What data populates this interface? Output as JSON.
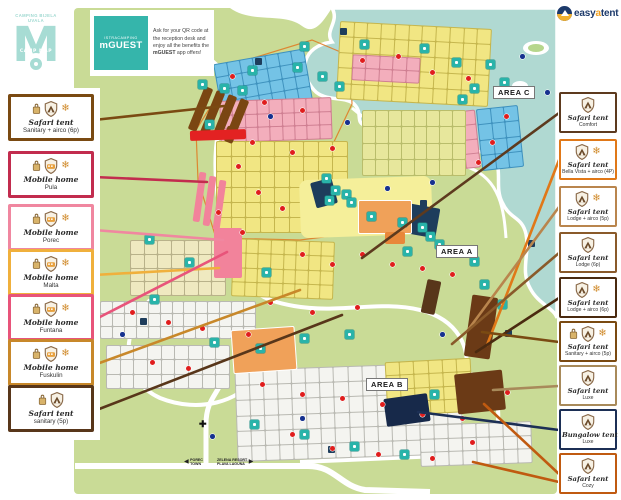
{
  "header": {
    "logo": {
      "line1": "CAMPING BIJELA UVALA",
      "mark": "M",
      "band": "CAMP MAP"
    },
    "mguest": {
      "brand_top": "ISTRACAMPING",
      "brand": "mGUEST",
      "body": "Ask for your QR code at the reception desk and enjoy all the benefits the ",
      "body_bold": "mGUEST",
      "body_end": " app offers!"
    },
    "easyatent": {
      "part1": "easy",
      "part2": "a",
      "part3": "tent"
    }
  },
  "palette": {
    "land": "#c9db96",
    "sea": "#b0d9d2",
    "road": "#ffffff",
    "facility": "#29b3a9",
    "plot_yellow": "#f1e683",
    "plot_pink": "#f3aebc",
    "plot_blue": "#74c3e6",
    "plot_white": "#f4f4f0",
    "red_marker": "#e01d1d",
    "blue_marker": "#16318f"
  },
  "legend_left": [
    {
      "title": "Safari tent",
      "sub": "Sanitary + airco (6p)",
      "color": "#7a4a12",
      "icons": [
        "bag",
        "shield-tent",
        "snow"
      ],
      "top": 94,
      "line_to": [
        224,
        106
      ]
    },
    {
      "title": "Mobile home",
      "sub": "Pula",
      "color": "#c22c4e",
      "icons": [
        "bag",
        "shield-home",
        "snow"
      ],
      "top": 151,
      "line_to": [
        207,
        182
      ]
    },
    {
      "title": "Mobile home",
      "sub": "Porec",
      "color": "#f087a0",
      "icons": [
        "bag",
        "shield-home",
        "snow"
      ],
      "top": 204,
      "line_to": [
        223,
        240
      ]
    },
    {
      "title": "Mobile home",
      "sub": "Malta",
      "color": "#f0b03c",
      "icons": [
        "bag",
        "shield-home",
        "snow"
      ],
      "top": 249,
      "line_to": [
        219,
        268
      ]
    },
    {
      "title": "Mobile home",
      "sub": "Funtana",
      "color": "#e8547a",
      "icons": [
        "bag",
        "shield-home",
        "snow"
      ],
      "top": 294,
      "line_to": [
        227,
        252
      ]
    },
    {
      "title": "Mobile home",
      "sub": "Fuskulin",
      "color": "#c8882a",
      "icons": [
        "bag",
        "shield-home",
        "snow"
      ],
      "top": 339,
      "line_to": [
        300,
        290
      ]
    },
    {
      "title": "Safari tent",
      "sub": "sanitary (5p)",
      "color": "#58361a",
      "icons": [
        "bag",
        "shield-tent"
      ],
      "top": 385,
      "line_to": [
        342,
        315
      ]
    }
  ],
  "legend_right": [
    {
      "title": "Safari tent",
      "sub": "Comfort",
      "color": "#5d3a1e",
      "icons": [
        "shield-tent"
      ],
      "top": 92,
      "line_to": [
        362,
        258
      ]
    },
    {
      "title": "Safari tent",
      "sub": "Bella Vista + airco (4P)",
      "color": "#e07818",
      "icons": [
        "shield-tent",
        "snow"
      ],
      "top": 139,
      "line_to": [
        487,
        345
      ]
    },
    {
      "title": "Safari tent",
      "sub": "Lodge + airco (5p)",
      "color": "#b9854d",
      "icons": [
        "shield-tent",
        "snow"
      ],
      "top": 186,
      "line_to": [
        468,
        330
      ]
    },
    {
      "title": "Safari tent",
      "sub": "Lodge (6p)",
      "color": "#8a5a2a",
      "icons": [
        "shield-tent"
      ],
      "top": 232,
      "line_to": [
        452,
        344
      ]
    },
    {
      "title": "Safari tent",
      "sub": "Lodge + airco (6p)",
      "color": "#4a2a10",
      "icons": [
        "shield-tent",
        "snow"
      ],
      "top": 277,
      "line_to": [
        476,
        352
      ]
    },
    {
      "title": "Safari tent",
      "sub": "Sanitary + airco (5p)",
      "color": "#7a4a12",
      "icons": [
        "bag",
        "shield-tent",
        "snow"
      ],
      "top": 321,
      "line_to": [
        482,
        332
      ]
    },
    {
      "title": "Safari tent",
      "sub": "Luxe",
      "color": "#a88a5a",
      "icons": [
        "shield-tent"
      ],
      "top": 365,
      "line_to": [
        493,
        390
      ]
    },
    {
      "title": "Bungalow tent",
      "sub": "Luxe",
      "color": "#1c2f55",
      "icons": [
        "shield-tent"
      ],
      "top": 409,
      "line_to": [
        418,
        412
      ]
    },
    {
      "title": "Safari tent",
      "sub": "Cozy",
      "color": "#c05a10",
      "icons": [
        "shield-tent"
      ],
      "top": 453,
      "line_to": [
        484,
        404
      ],
      "line_to2": [
        473,
        462
      ]
    }
  ],
  "map": {
    "area_labels": [
      {
        "text": "AREA A",
        "x": 436,
        "y": 245
      },
      {
        "text": "AREA B",
        "x": 366,
        "y": 378
      },
      {
        "text": "AREA C",
        "x": 493,
        "y": 86
      }
    ],
    "signs": [
      {
        "lines": [
          "POREC",
          "TOWN"
        ],
        "arrow": "left",
        "x": 184,
        "y": 458
      },
      {
        "lines": [
          "ZELENA RESORT",
          "PLAVA LAGUNA"
        ],
        "arrow": "right",
        "x": 217,
        "y": 458
      }
    ],
    "zones": [
      {
        "x": 217,
        "y": 56,
        "w": 92,
        "h": 52,
        "cols": 7,
        "rows": 4,
        "color": "#74c3e6",
        "gap": "#3f92be",
        "rot": -10
      },
      {
        "x": 220,
        "y": 99,
        "w": 112,
        "h": 42,
        "cols": 9,
        "rows": 3,
        "color": "#f3aebc",
        "gap": "#cf7f92",
        "rot": -2
      },
      {
        "x": 216,
        "y": 141,
        "w": 132,
        "h": 92,
        "cols": 9,
        "rows": 6,
        "color": "#f1e683",
        "gap": "#c5b64e",
        "rot": 0
      },
      {
        "x": 338,
        "y": 25,
        "w": 152,
        "h": 78,
        "cols": 11,
        "rows": 5,
        "color": "#f1e683",
        "gap": "#c5b64e",
        "rot": 3
      },
      {
        "x": 352,
        "y": 56,
        "w": 68,
        "h": 26,
        "cols": 5,
        "rows": 2,
        "color": "#f3aebc",
        "gap": "#cf7f92",
        "rot": 3
      },
      {
        "x": 479,
        "y": 107,
        "w": 42,
        "h": 62,
        "cols": 3,
        "rows": 4,
        "color": "#74c3e6",
        "gap": "#3f92be",
        "rot": -6
      },
      {
        "x": 448,
        "y": 111,
        "w": 30,
        "h": 58,
        "cols": 2,
        "rows": 4,
        "color": "#f3aebc",
        "gap": "#cf7f92",
        "rot": -6
      },
      {
        "x": 362,
        "y": 110,
        "w": 104,
        "h": 66,
        "cols": 8,
        "rows": 4,
        "color": "#e7e79c",
        "gap": "#b9bd6b",
        "rot": 0
      },
      {
        "x": 130,
        "y": 240,
        "w": 96,
        "h": 56,
        "cols": 7,
        "rows": 4,
        "color": "#efe9c0",
        "gap": "#b9b28a",
        "rot": 0
      },
      {
        "x": 100,
        "y": 301,
        "w": 156,
        "h": 38,
        "cols": 13,
        "rows": 3,
        "color": "#f4f4f0",
        "gap": "#b9b9b2",
        "rot": 0
      },
      {
        "x": 106,
        "y": 345,
        "w": 124,
        "h": 44,
        "cols": 9,
        "rows": 3,
        "color": "#f4f4f0",
        "gap": "#b9b9b2",
        "rot": 0
      },
      {
        "x": 236,
        "y": 366,
        "w": 226,
        "h": 92,
        "cols": 16,
        "rows": 6,
        "color": "#f4f4f0",
        "gap": "#b9b9b2",
        "rot": -2
      },
      {
        "x": 386,
        "y": 360,
        "w": 86,
        "h": 54,
        "cols": 6,
        "rows": 4,
        "color": "#f1e683",
        "gap": "#c5b64e",
        "rot": -3
      },
      {
        "x": 420,
        "y": 423,
        "w": 112,
        "h": 42,
        "cols": 8,
        "rows": 3,
        "color": "#f4f4f0",
        "gap": "#b9b9b2",
        "rot": -2
      },
      {
        "x": 232,
        "y": 240,
        "w": 102,
        "h": 58,
        "cols": 8,
        "rows": 4,
        "color": "#f1e683",
        "gap": "#c5b64e",
        "rot": 2
      }
    ],
    "shapes": [
      {
        "name": "central-facility-strip",
        "x": 300,
        "y": 178,
        "w": 132,
        "h": 58,
        "color": "#f5ef9a",
        "rot": -2,
        "r": 8
      },
      {
        "name": "facility-building",
        "x": 313,
        "y": 180,
        "w": 22,
        "h": 26,
        "color": "#1e3d5c",
        "rot": -15
      },
      {
        "name": "facility-building",
        "x": 408,
        "y": 206,
        "w": 30,
        "h": 30,
        "color": "#1e3d5c",
        "rot": 10
      },
      {
        "name": "bungalow-tent-zone",
        "x": 385,
        "y": 396,
        "w": 44,
        "h": 28,
        "color": "#17294a",
        "rot": -8
      },
      {
        "name": "safari-tent-zone",
        "x": 468,
        "y": 296,
        "w": 26,
        "h": 62,
        "color": "#6b3a16",
        "rot": 8
      },
      {
        "name": "safari-tent-zone",
        "x": 456,
        "y": 372,
        "w": 48,
        "h": 40,
        "color": "#6b3a16",
        "rot": -6
      },
      {
        "name": "safari-tent-zone",
        "x": 424,
        "y": 280,
        "w": 14,
        "h": 34,
        "color": "#58361a",
        "rot": 12
      },
      {
        "name": "safari-tent-row",
        "x": 196,
        "y": 86,
        "w": 9,
        "h": 46,
        "color": "#7a4612",
        "rot": 22
      },
      {
        "name": "safari-tent-row",
        "x": 208,
        "y": 90,
        "w": 9,
        "h": 46,
        "color": "#7a4612",
        "rot": 22
      },
      {
        "name": "safari-tent-row",
        "x": 220,
        "y": 94,
        "w": 9,
        "h": 46,
        "color": "#7a4612",
        "rot": 22
      },
      {
        "name": "safari-tent-row",
        "x": 232,
        "y": 98,
        "w": 9,
        "h": 46,
        "color": "#7a4612",
        "rot": 22
      },
      {
        "name": "safari-tent-row",
        "x": 226,
        "y": 128,
        "w": 16,
        "h": 8,
        "color": "#7a4612",
        "rot": 22
      },
      {
        "name": "mobile-home-row",
        "x": 196,
        "y": 172,
        "w": 7,
        "h": 50,
        "color": "#f2839b",
        "rot": 8
      },
      {
        "name": "mobile-home-row",
        "x": 206,
        "y": 176,
        "w": 7,
        "h": 50,
        "color": "#f2839b",
        "rot": 8
      },
      {
        "name": "mobile-home-row",
        "x": 216,
        "y": 180,
        "w": 7,
        "h": 50,
        "color": "#f2839b",
        "rot": 8
      },
      {
        "name": "mobile-home-block",
        "x": 214,
        "y": 228,
        "w": 28,
        "h": 50,
        "color": "#f2839b",
        "rot": 0
      },
      {
        "name": "tennis-courts",
        "x": 358,
        "y": 200,
        "w": 52,
        "h": 32,
        "color": "#f0a159",
        "rot": 0,
        "border": "#fff"
      },
      {
        "name": "sports-courts",
        "x": 232,
        "y": 328,
        "w": 62,
        "h": 42,
        "color": "#f0a159",
        "rot": -4,
        "border": "#fff"
      },
      {
        "name": "sports-court-small",
        "x": 385,
        "y": 232,
        "w": 20,
        "h": 12,
        "color": "#e8873a",
        "rot": 0
      },
      {
        "name": "map-banner",
        "x": 190,
        "y": 130,
        "w": 56,
        "h": 10,
        "color": "#e32222",
        "rot": -2
      }
    ],
    "facilities": [
      [
        248,
        66
      ],
      [
        238,
        86
      ],
      [
        198,
        80
      ],
      [
        220,
        84
      ],
      [
        293,
        63
      ],
      [
        318,
        72
      ],
      [
        335,
        82
      ],
      [
        300,
        42
      ],
      [
        360,
        40
      ],
      [
        420,
        44
      ],
      [
        452,
        58
      ],
      [
        470,
        84
      ],
      [
        500,
        78
      ],
      [
        458,
        95
      ],
      [
        486,
        60
      ],
      [
        322,
        174
      ],
      [
        331,
        186
      ],
      [
        342,
        190
      ],
      [
        325,
        196
      ],
      [
        347,
        198
      ],
      [
        367,
        212
      ],
      [
        398,
        218
      ],
      [
        418,
        223
      ],
      [
        426,
        232
      ],
      [
        435,
        240
      ],
      [
        403,
        247
      ],
      [
        455,
        247
      ],
      [
        470,
        257
      ],
      [
        480,
        280
      ],
      [
        498,
        300
      ],
      [
        145,
        235
      ],
      [
        185,
        258
      ],
      [
        150,
        295
      ],
      [
        210,
        338
      ],
      [
        256,
        344
      ],
      [
        300,
        334
      ],
      [
        345,
        330
      ],
      [
        250,
        420
      ],
      [
        300,
        430
      ],
      [
        350,
        442
      ],
      [
        400,
        450
      ],
      [
        430,
        390
      ],
      [
        205,
        120
      ],
      [
        262,
        268
      ]
    ],
    "facilities_dark": [
      [
        255,
        58
      ],
      [
        340,
        28
      ],
      [
        528,
        240
      ],
      [
        420,
        200
      ],
      [
        140,
        318
      ],
      [
        328,
        446
      ],
      [
        505,
        330
      ]
    ],
    "red_dots": [
      [
        230,
        74
      ],
      [
        262,
        100
      ],
      [
        300,
        108
      ],
      [
        250,
        140
      ],
      [
        290,
        150
      ],
      [
        330,
        146
      ],
      [
        360,
        58
      ],
      [
        396,
        54
      ],
      [
        430,
        70
      ],
      [
        466,
        76
      ],
      [
        504,
        114
      ],
      [
        490,
        140
      ],
      [
        476,
        160
      ],
      [
        236,
        164
      ],
      [
        256,
        190
      ],
      [
        280,
        206
      ],
      [
        216,
        210
      ],
      [
        240,
        230
      ],
      [
        300,
        252
      ],
      [
        330,
        262
      ],
      [
        360,
        252
      ],
      [
        390,
        262
      ],
      [
        420,
        266
      ],
      [
        450,
        272
      ],
      [
        130,
        310
      ],
      [
        166,
        320
      ],
      [
        200,
        326
      ],
      [
        246,
        332
      ],
      [
        150,
        360
      ],
      [
        186,
        366
      ],
      [
        260,
        382
      ],
      [
        300,
        392
      ],
      [
        340,
        396
      ],
      [
        380,
        402
      ],
      [
        420,
        412
      ],
      [
        460,
        416
      ],
      [
        290,
        432
      ],
      [
        330,
        446
      ],
      [
        376,
        452
      ],
      [
        430,
        456
      ],
      [
        470,
        440
      ],
      [
        505,
        390
      ],
      [
        268,
        300
      ],
      [
        310,
        310
      ],
      [
        355,
        305
      ]
    ],
    "blue_dots": [
      [
        268,
        114
      ],
      [
        345,
        120
      ],
      [
        520,
        54
      ],
      [
        545,
        90
      ],
      [
        430,
        180
      ],
      [
        120,
        332
      ],
      [
        210,
        434
      ],
      [
        385,
        186
      ],
      [
        300,
        416
      ],
      [
        440,
        332
      ]
    ]
  }
}
